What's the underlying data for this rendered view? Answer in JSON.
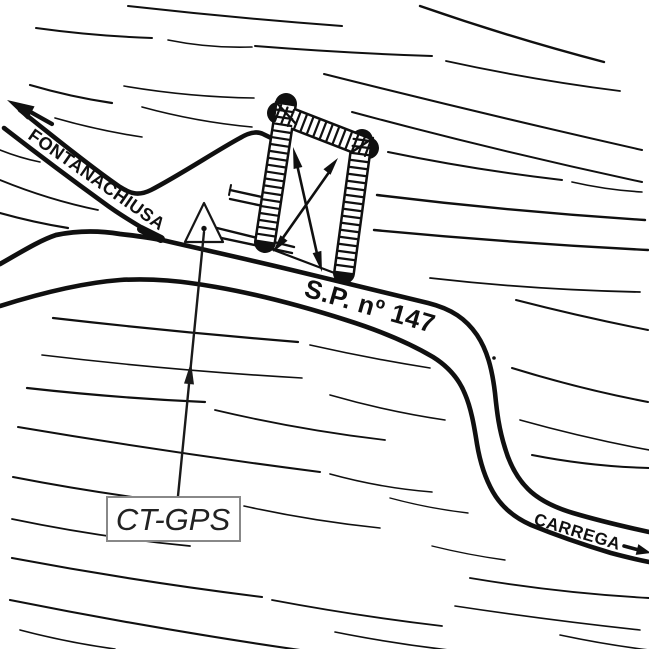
{
  "map": {
    "background": "#ffffff",
    "ink": "#101010",
    "labels": {
      "road_northwest": "FONTANACHIUSA",
      "road_provincial": "S.P. nº 147",
      "road_southeast": "CARREGA",
      "control_point": "CT-GPS"
    },
    "callout": {
      "border_color": "#888888",
      "text_color": "#222222"
    },
    "symbols": {
      "survey_marker": "triangle-with-center-dot",
      "building": "hatched-wall-building-plan-with-crossed-arrows",
      "direction_arrow_nw": "arrow-to-fontanachiusa",
      "direction_arrow_se": "arrow-to-carrega"
    }
  }
}
